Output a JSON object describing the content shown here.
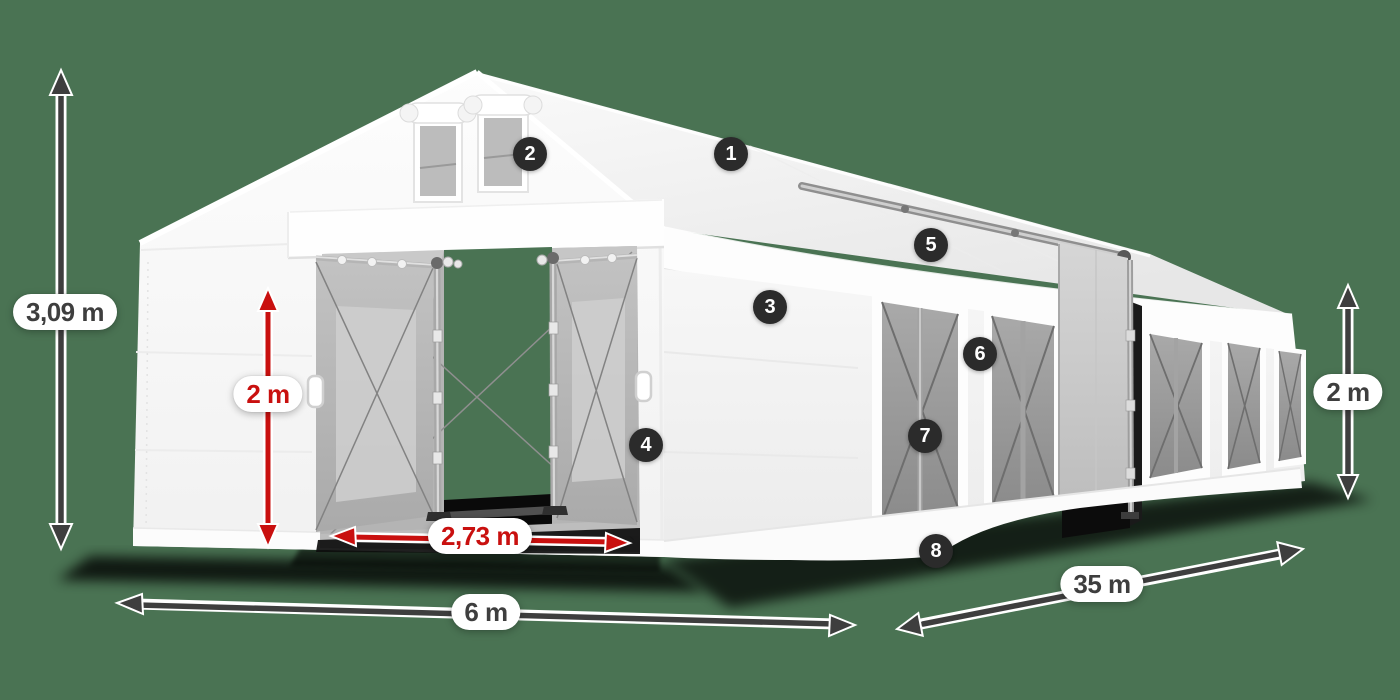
{
  "dimensions": {
    "total_height": {
      "value": "3,09 m",
      "style": "dark",
      "orientation": "vertical"
    },
    "entrance_height": {
      "value": "2 m",
      "style": "red",
      "orientation": "vertical"
    },
    "entrance_width": {
      "value": "2,73 m",
      "style": "red",
      "orientation": "horizontal"
    },
    "front_width": {
      "value": "6 m",
      "style": "dark",
      "orientation": "horizontal"
    },
    "side_length": {
      "value": "35 m",
      "style": "dark",
      "orientation": "diagonal"
    },
    "side_wall_height": {
      "value": "2 m",
      "style": "dark",
      "orientation": "vertical"
    }
  },
  "callouts": [
    {
      "number": "1"
    },
    {
      "number": "2"
    },
    {
      "number": "3"
    },
    {
      "number": "4"
    },
    {
      "number": "5"
    },
    {
      "number": "6"
    },
    {
      "number": "7"
    },
    {
      "number": "8"
    }
  ],
  "colors": {
    "background": "#4a7353",
    "dimension_red": "#c9100f",
    "dimension_dark": "#3e3e3e",
    "badge_background": "#2b2b2b",
    "pill_background": "#ffffff",
    "tent_white": "#fbfbfb"
  }
}
